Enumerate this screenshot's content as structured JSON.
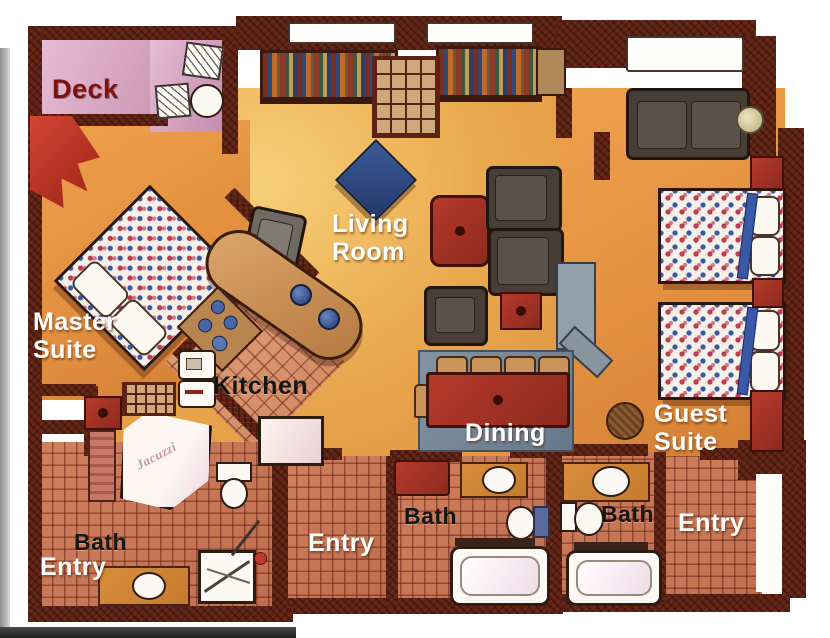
{
  "plan_type": "residential floor plan, hand-drawn watercolor rendering",
  "rooms": {
    "deck": {
      "label": "Deck",
      "label_color": "#7e120e"
    },
    "living_room": {
      "line1": "Living",
      "line2": "Room",
      "label_color": "#ffffff"
    },
    "master_suite": {
      "line1": "Master",
      "line2": "Suite",
      "label_color": "#ffffff"
    },
    "kitchen": {
      "label": "Kitchen",
      "label_color": "#161616"
    },
    "dining": {
      "label": "Dining",
      "label_color": "#ffffff"
    },
    "guest_suite": {
      "line1": "Guest",
      "line2": "Suite",
      "label_color": "#ffffff"
    },
    "master_bath": {
      "label": "Bath",
      "label_color": "#161616"
    },
    "master_entry": {
      "label": "Entry",
      "label_color": "#ffffff"
    },
    "main_entry": {
      "label": "Entry",
      "label_color": "#ffffff"
    },
    "main_bath": {
      "label": "Bath",
      "label_color": "#161616"
    },
    "guest_bath": {
      "label": "Bath",
      "label_color": "#161616"
    },
    "guest_entry": {
      "label": "Entry",
      "label_color": "#ffffff"
    }
  },
  "annotations": {
    "jacuzzi_tub": {
      "label": "Jacuzzi"
    }
  },
  "palette": {
    "wall_dark": "#5d2213",
    "floor_warm": "#eaa94e",
    "deck_pink": "#cf9cba",
    "tile_terracotta": "#c97a5c",
    "accent_red": "#b53a2b",
    "accent_blue": "#3a58a8",
    "rug_gray_blue": "#7d8c9c",
    "fixture_white": "#fcf8f4"
  },
  "furniture": [
    "deck-table",
    "deck-chair",
    "deck-round-table",
    "bookshelf",
    "fireplace-media-grid",
    "blue-ottoman",
    "red-coffee-table",
    "sectional-sofa",
    "red-side-table",
    "armchair",
    "desk-chair",
    "master-bed",
    "guest-bed",
    "nightstand",
    "loveseat",
    "floor-lamp",
    "wicker-table",
    "media-console",
    "kitchen-island",
    "cooktop-counter",
    "refrigerator",
    "range",
    "dishwasher",
    "bar-stool",
    "dining-table",
    "dining-chair",
    "area-rug",
    "jacuzzi-corner-tub",
    "shower-stall",
    "bathtub",
    "toilet",
    "vanity-sink",
    "entry-mat"
  ]
}
